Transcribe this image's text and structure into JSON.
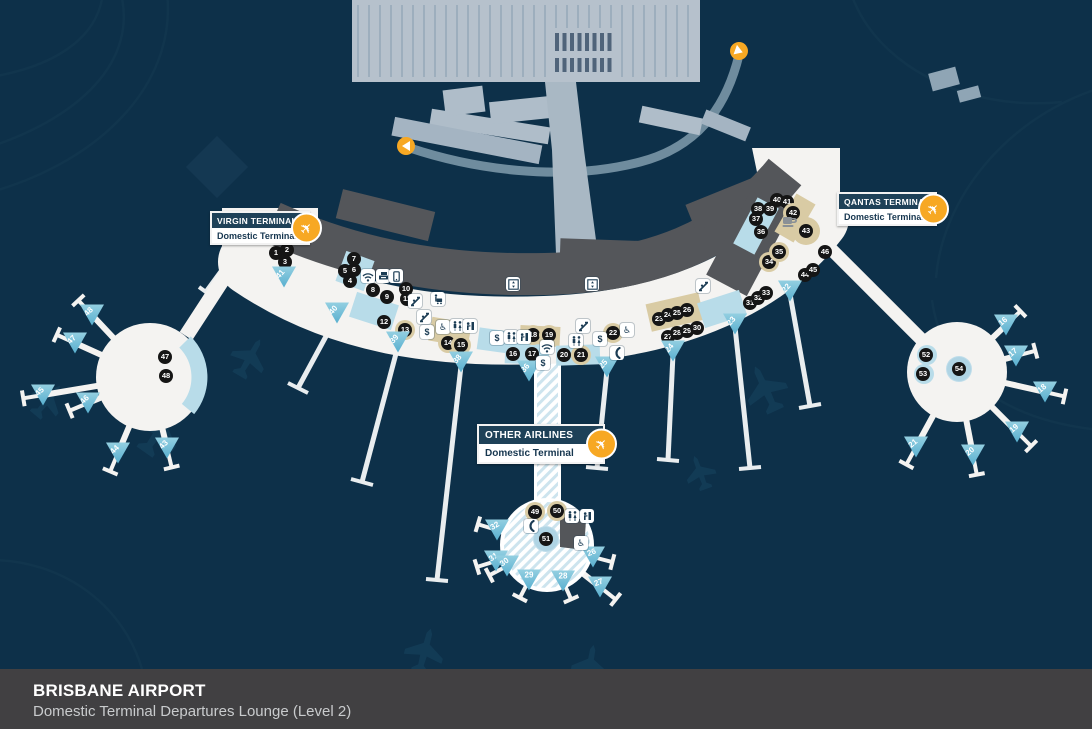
{
  "footer": {
    "title": "BRISBANE AIRPORT",
    "subtitle": "Domestic Terminal Departures Lounge (Level 2)"
  },
  "colors": {
    "background": "#0D3049",
    "footer_bg": "#414042",
    "terminal_white": "#F4F3F1",
    "airside_gray": "#54565A",
    "gate_blue": "#7EC3DB",
    "retail_tan": "#D9CBA4",
    "marker_black": "#151515",
    "accent_orange": "#F7A823",
    "carpark_gray": "#B6C1CC",
    "road_gray": "#6F8C9E"
  },
  "terminal_labels": [
    {
      "id": "virgin",
      "name": "VIRGIN TERMINAL",
      "sub": "Domestic Terminal",
      "x": 210,
      "y": 211,
      "w": 96,
      "big": false
    },
    {
      "id": "qantas",
      "name": "QANTAS TERMINAL",
      "sub": "Domestic Terminal",
      "x": 837,
      "y": 192,
      "w": 96,
      "big": false
    },
    {
      "id": "other",
      "name": "OTHER AIRLINES",
      "sub": "Domestic Terminal",
      "x": 477,
      "y": 424,
      "w": 124,
      "big": true
    }
  ],
  "satellites": {
    "left": {
      "cx": 150,
      "cy": 377,
      "r": 54
    },
    "right": {
      "cx": 957,
      "cy": 372,
      "r": 50
    },
    "bottom": {
      "cx": 547,
      "cy": 545,
      "r": 47
    }
  },
  "poi_markers": [
    {
      "n": 1,
      "x": 276,
      "y": 253
    },
    {
      "n": 2,
      "x": 287,
      "y": 250
    },
    {
      "n": 3,
      "x": 285,
      "y": 262
    },
    {
      "n": 4,
      "x": 350,
      "y": 281
    },
    {
      "n": 5,
      "x": 345,
      "y": 271
    },
    {
      "n": 6,
      "x": 354,
      "y": 270
    },
    {
      "n": 7,
      "x": 354,
      "y": 259
    },
    {
      "n": 8,
      "x": 373,
      "y": 290
    },
    {
      "n": 9,
      "x": 387,
      "y": 297
    },
    {
      "n": 10,
      "x": 406,
      "y": 289
    },
    {
      "n": 11,
      "x": 407,
      "y": 299
    },
    {
      "n": 12,
      "x": 384,
      "y": 322
    },
    {
      "n": 13,
      "x": 405,
      "y": 330,
      "style": "tan"
    },
    {
      "n": 14,
      "x": 448,
      "y": 343,
      "style": "tan"
    },
    {
      "n": 15,
      "x": 461,
      "y": 345,
      "style": "tan"
    },
    {
      "n": 16,
      "x": 513,
      "y": 354
    },
    {
      "n": 17,
      "x": 532,
      "y": 354
    },
    {
      "n": 18,
      "x": 533,
      "y": 335,
      "style": "tan"
    },
    {
      "n": 19,
      "x": 549,
      "y": 335,
      "style": "tan"
    },
    {
      "n": 20,
      "x": 564,
      "y": 355
    },
    {
      "n": 21,
      "x": 581,
      "y": 355,
      "style": "tan"
    },
    {
      "n": 22,
      "x": 613,
      "y": 333,
      "style": "tan"
    },
    {
      "n": 23,
      "x": 659,
      "y": 319
    },
    {
      "n": 24,
      "x": 668,
      "y": 315
    },
    {
      "n": 25,
      "x": 677,
      "y": 313
    },
    {
      "n": 26,
      "x": 687,
      "y": 310
    },
    {
      "n": 27,
      "x": 668,
      "y": 337
    },
    {
      "n": 28,
      "x": 677,
      "y": 333
    },
    {
      "n": 29,
      "x": 687,
      "y": 331
    },
    {
      "n": 30,
      "x": 697,
      "y": 328
    },
    {
      "n": 31,
      "x": 750,
      "y": 303
    },
    {
      "n": 32,
      "x": 758,
      "y": 298
    },
    {
      "n": 33,
      "x": 766,
      "y": 293
    },
    {
      "n": 34,
      "x": 769,
      "y": 262,
      "style": "tan"
    },
    {
      "n": 35,
      "x": 779,
      "y": 252,
      "style": "tan"
    },
    {
      "n": 36,
      "x": 761,
      "y": 232
    },
    {
      "n": 37,
      "x": 756,
      "y": 219
    },
    {
      "n": 38,
      "x": 758,
      "y": 209
    },
    {
      "n": 39,
      "x": 770,
      "y": 209
    },
    {
      "n": 40,
      "x": 777,
      "y": 200
    },
    {
      "n": 41,
      "x": 787,
      "y": 202
    },
    {
      "n": 42,
      "x": 793,
      "y": 213,
      "style": "tan"
    },
    {
      "n": 43,
      "x": 806,
      "y": 231,
      "style": "tanbig"
    },
    {
      "n": 44,
      "x": 805,
      "y": 275
    },
    {
      "n": 45,
      "x": 813,
      "y": 270
    },
    {
      "n": 46,
      "x": 825,
      "y": 252
    },
    {
      "n": 47,
      "x": 165,
      "y": 357
    },
    {
      "n": 48,
      "x": 166,
      "y": 376
    },
    {
      "n": 49,
      "x": 535,
      "y": 512,
      "style": "tan"
    },
    {
      "n": 50,
      "x": 557,
      "y": 511,
      "style": "tan"
    },
    {
      "n": 51,
      "x": 546,
      "y": 539,
      "style": "bluering"
    },
    {
      "n": 52,
      "x": 926,
      "y": 355
    },
    {
      "n": 53,
      "x": 923,
      "y": 374
    },
    {
      "n": 54,
      "x": 959,
      "y": 369,
      "style": "bluering"
    }
  ],
  "gates": [
    {
      "n": 41,
      "x": 284,
      "y": 277,
      "rot": -50,
      "sat": "curve"
    },
    {
      "n": 40,
      "x": 337,
      "y": 313,
      "rot": -50,
      "sat": "curve"
    },
    {
      "n": 39,
      "x": 398,
      "y": 342,
      "rot": -50,
      "sat": "curve"
    },
    {
      "n": 38,
      "x": 461,
      "y": 362,
      "rot": -50,
      "sat": "curve"
    },
    {
      "n": 36,
      "x": 529,
      "y": 371,
      "rot": -50,
      "sat": "curve"
    },
    {
      "n": 25,
      "x": 607,
      "y": 367,
      "rot": -50,
      "sat": "curve"
    },
    {
      "n": 24,
      "x": 673,
      "y": 351,
      "rot": -50,
      "sat": "curve"
    },
    {
      "n": 23,
      "x": 735,
      "y": 324,
      "rot": -50,
      "sat": "curve"
    },
    {
      "n": 22,
      "x": 790,
      "y": 291,
      "rot": -50,
      "sat": "curve"
    },
    {
      "n": 48,
      "x": 92,
      "y": 315,
      "rot": -45,
      "sat": "left"
    },
    {
      "n": 47,
      "x": 75,
      "y": 343,
      "rot": -45,
      "sat": "left"
    },
    {
      "n": 45,
      "x": 43,
      "y": 395,
      "rot": -45,
      "sat": "left"
    },
    {
      "n": 46,
      "x": 88,
      "y": 403,
      "rot": -45,
      "sat": "left"
    },
    {
      "n": 44,
      "x": 118,
      "y": 453,
      "rot": -45,
      "sat": "left"
    },
    {
      "n": 43,
      "x": 167,
      "y": 448,
      "rot": -45,
      "sat": "left"
    },
    {
      "n": 16,
      "x": 1006,
      "y": 325,
      "rot": -40,
      "sat": "right"
    },
    {
      "n": 17,
      "x": 1016,
      "y": 356,
      "rot": -40,
      "sat": "right"
    },
    {
      "n": 18,
      "x": 1045,
      "y": 392,
      "rot": -40,
      "sat": "right"
    },
    {
      "n": 19,
      "x": 1017,
      "y": 432,
      "rot": -40,
      "sat": "right"
    },
    {
      "n": 20,
      "x": 973,
      "y": 455,
      "rot": -40,
      "sat": "right"
    },
    {
      "n": 21,
      "x": 916,
      "y": 447,
      "rot": -40,
      "sat": "right"
    },
    {
      "n": 32,
      "x": 497,
      "y": 530,
      "rot": -30,
      "sat": "bottom"
    },
    {
      "n": 31,
      "x": 496,
      "y": 561,
      "rot": -35,
      "sat": "bottom"
    },
    {
      "n": 30,
      "x": 507,
      "y": 566,
      "rot": -35,
      "sat": "bottom"
    },
    {
      "n": 29,
      "x": 529,
      "y": 580,
      "rot": 0,
      "sat": "bottom"
    },
    {
      "n": 28,
      "x": 563,
      "y": 581,
      "rot": 0,
      "sat": "bottom"
    },
    {
      "n": 27,
      "x": 600,
      "y": 587,
      "rot": -20,
      "sat": "bottom"
    },
    {
      "n": 26,
      "x": 593,
      "y": 557,
      "rot": -20,
      "sat": "bottom"
    }
  ],
  "amenities": [
    {
      "type": "wifi",
      "x": 368,
      "y": 276
    },
    {
      "type": "wifi",
      "x": 547,
      "y": 347
    },
    {
      "type": "copier",
      "x": 383,
      "y": 276
    },
    {
      "type": "mobile",
      "x": 396,
      "y": 276
    },
    {
      "type": "lift",
      "x": 513,
      "y": 284
    },
    {
      "type": "lift",
      "x": 592,
      "y": 284
    },
    {
      "type": "escalator",
      "x": 415,
      "y": 301
    },
    {
      "type": "escalator",
      "x": 424,
      "y": 317
    },
    {
      "type": "escalator",
      "x": 583,
      "y": 326
    },
    {
      "type": "escalator",
      "x": 703,
      "y": 286
    },
    {
      "type": "dollar",
      "x": 427,
      "y": 332
    },
    {
      "type": "dollar",
      "x": 497,
      "y": 338
    },
    {
      "type": "dollar",
      "x": 543,
      "y": 363
    },
    {
      "type": "dollar",
      "x": 600,
      "y": 339
    },
    {
      "type": "wheelchair",
      "x": 443,
      "y": 327
    },
    {
      "type": "wheelchair",
      "x": 627,
      "y": 330
    },
    {
      "type": "wheelchair",
      "x": 581,
      "y": 543
    },
    {
      "type": "restrooms",
      "x": 457,
      "y": 326
    },
    {
      "type": "restrooms",
      "x": 511,
      "y": 337
    },
    {
      "type": "restrooms",
      "x": 576,
      "y": 341
    },
    {
      "type": "restrooms",
      "x": 572,
      "y": 516
    },
    {
      "type": "fountain",
      "x": 470,
      "y": 326
    },
    {
      "type": "fountain",
      "x": 524,
      "y": 337
    },
    {
      "type": "fountain",
      "x": 587,
      "y": 516
    },
    {
      "type": "phone",
      "x": 617,
      "y": 353
    },
    {
      "type": "phone",
      "x": 531,
      "y": 526
    },
    {
      "type": "trolley",
      "x": 438,
      "y": 299
    },
    {
      "type": "cafe",
      "x": 790,
      "y": 222
    }
  ],
  "road_markers": [
    {
      "x": 406,
      "y": 146,
      "dir": 0
    },
    {
      "x": 739,
      "y": 51,
      "dir": 200
    }
  ]
}
